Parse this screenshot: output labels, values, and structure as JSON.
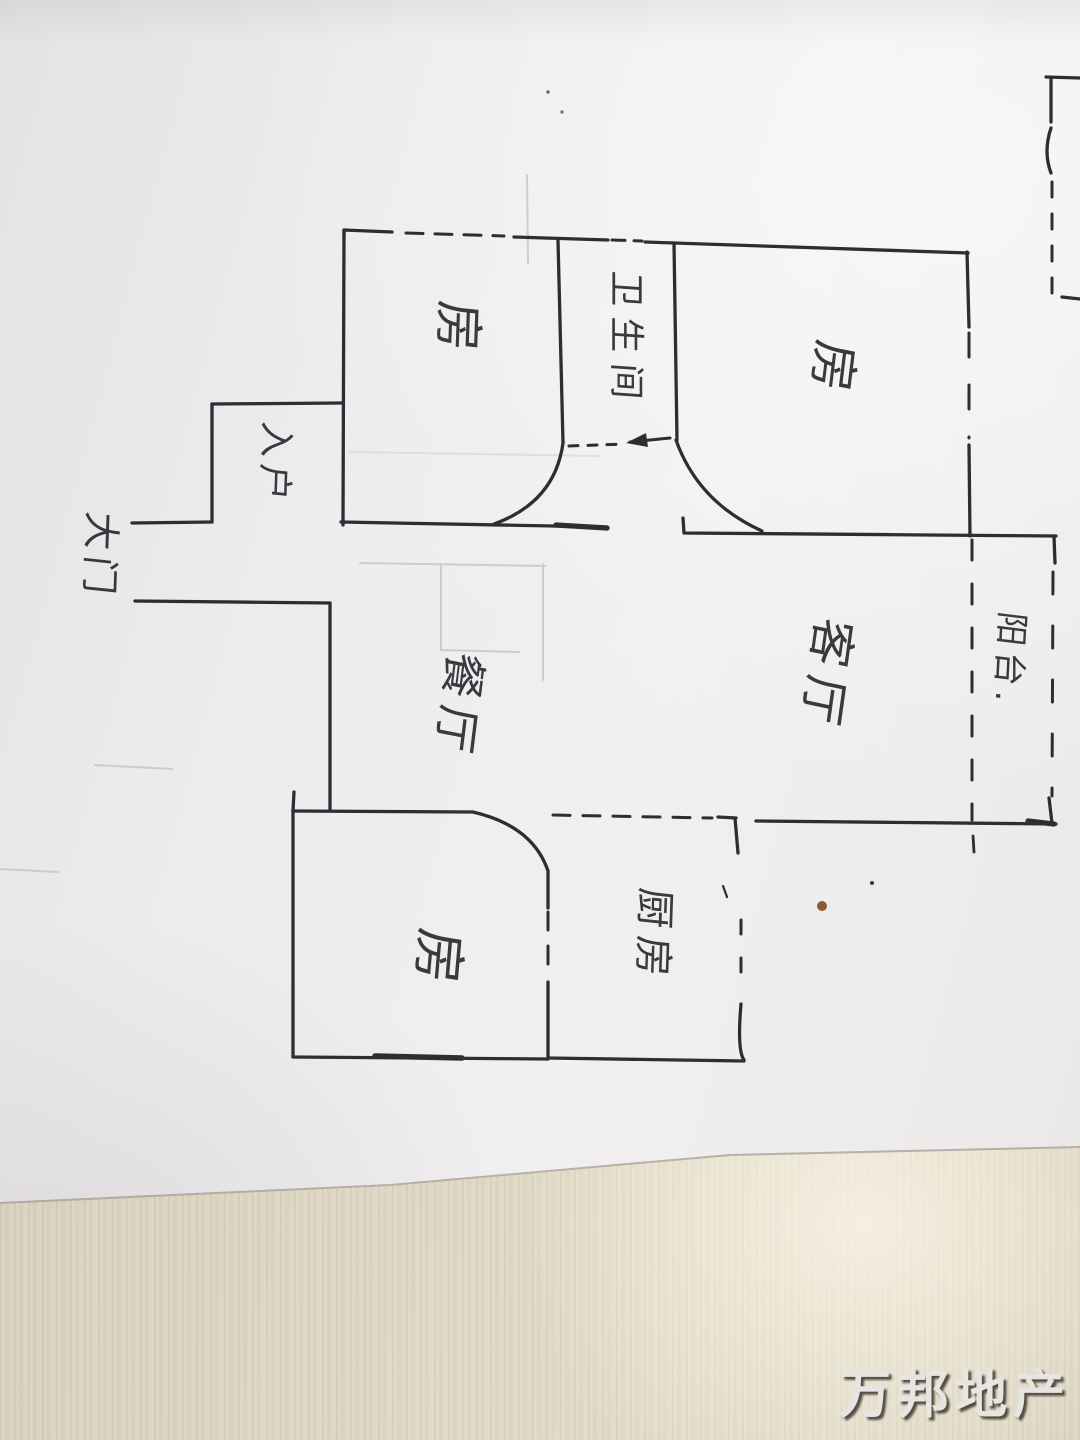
{
  "photo": {
    "description": "Hand-drawn apartment floor plan sketched in ink on a sheet of paper lying on a wooden table",
    "palette": {
      "ink": "#2d2d32",
      "paper": "#efedee",
      "table_wood": "#dcd5c2",
      "pencil_guides": "#c7c3c9",
      "stain": "#8d5a38"
    }
  },
  "rooms": [
    {
      "id": "bedroom-top-left",
      "label": "房"
    },
    {
      "id": "bathroom",
      "label": "卫生间"
    },
    {
      "id": "bedroom-top-right",
      "label": "房"
    },
    {
      "id": "entrance",
      "label": "入户"
    },
    {
      "id": "main-door",
      "label": "大门"
    },
    {
      "id": "dining-room",
      "label": "餐厅"
    },
    {
      "id": "living-room",
      "label": "客厅"
    },
    {
      "id": "balcony",
      "label": "阳台."
    },
    {
      "id": "bedroom-bottom",
      "label": "房"
    },
    {
      "id": "kitchen",
      "label": "厨房"
    }
  ],
  "watermark": {
    "text": "万邦地产",
    "color": "#e7e5e1",
    "shadow_color": "#423c32"
  }
}
